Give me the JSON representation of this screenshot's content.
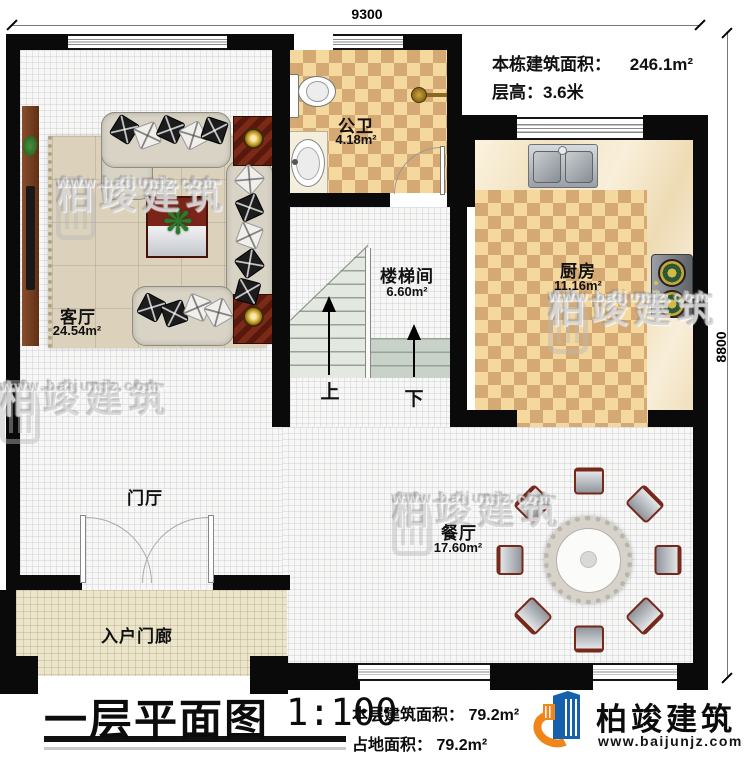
{
  "dimensions": {
    "width": "9300",
    "height": "8800"
  },
  "header_info": {
    "building_area_label": "本栋建筑面积：",
    "building_area_value": "246.1m²",
    "floor_height": "层高：3.6米"
  },
  "rooms": {
    "living": {
      "name": "客厅",
      "area": "24.54m²"
    },
    "bath": {
      "name": "公卫",
      "area": "4.18m²"
    },
    "stairwell": {
      "name": "楼梯间",
      "area": "6.60m²"
    },
    "kitchen": {
      "name": "厨房",
      "area": "11.16m²"
    },
    "dining": {
      "name": "餐厅",
      "area": "17.60m²"
    },
    "foyer": {
      "name": "门厅"
    },
    "porch": {
      "name": "入户门廊"
    }
  },
  "stairs": {
    "up": "上",
    "down": "下"
  },
  "title_block": {
    "title": "一层平面图",
    "scale": "1:100",
    "floor_area_label": "本层建筑面积：",
    "floor_area_value": "79.2m²",
    "land_area_label": "占地面积：",
    "land_area_value": "79.2m²"
  },
  "brand": {
    "name": "柏竣建筑",
    "url": "www.baijunjz.com"
  },
  "watermark": {
    "name": "柏竣建筑",
    "url": "www.baijunjz.com"
  },
  "colors": {
    "wall": "#0a0a0a",
    "checker_light": "#f4d89e",
    "checker_dark": "#d5a973",
    "brand_blue": "#1661ad",
    "brand_orange": "#f08519"
  }
}
